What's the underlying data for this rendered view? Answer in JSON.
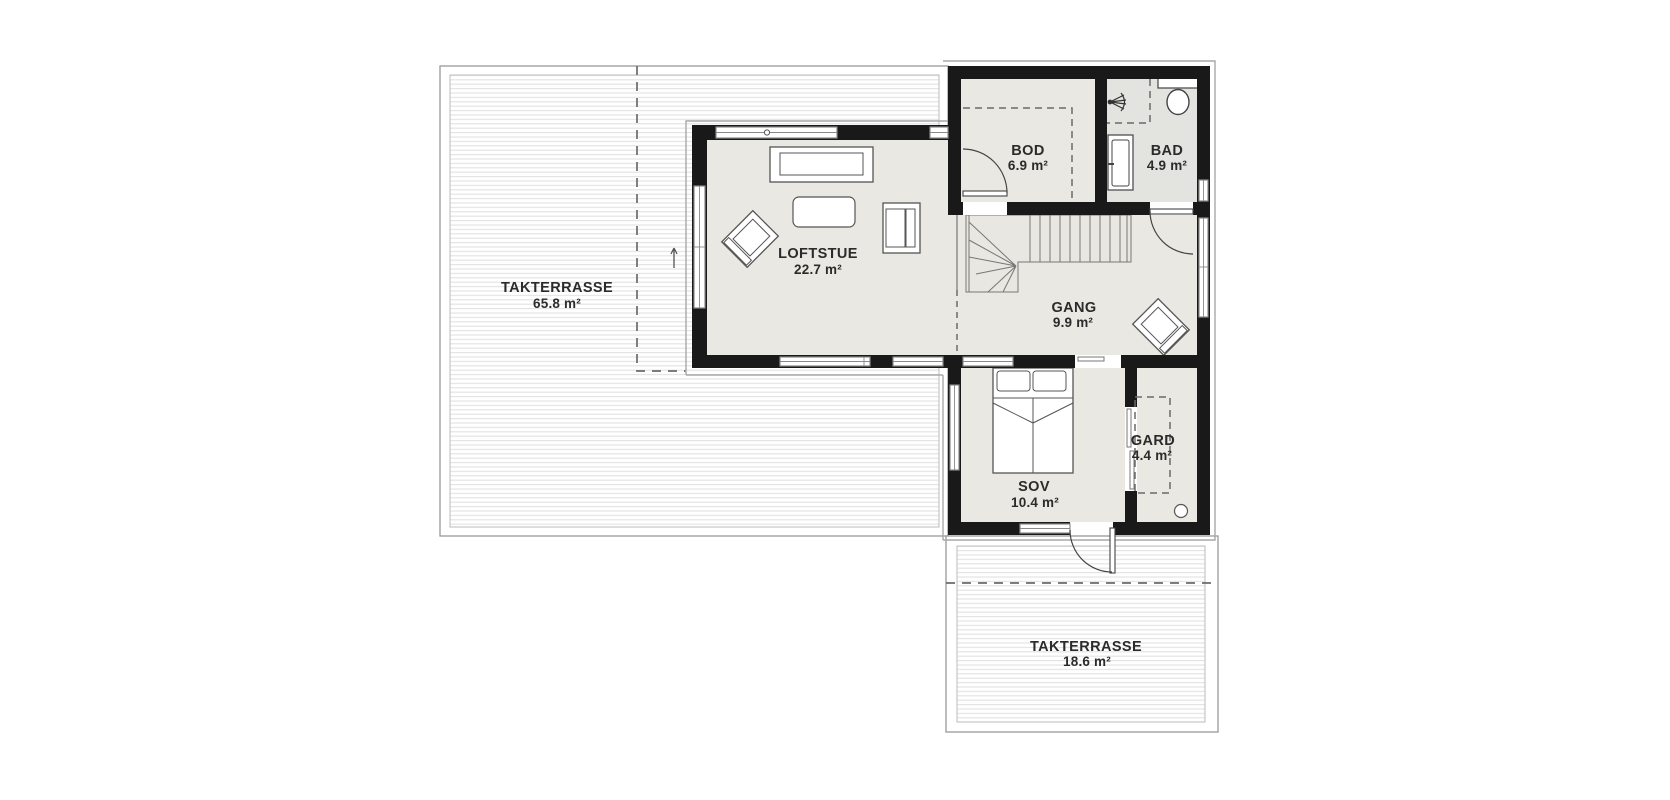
{
  "floorplan": {
    "rooms": [
      {
        "id": "takterrasse-large",
        "name": "TAKTERRASSE",
        "area": "65.8 m²"
      },
      {
        "id": "loftstue",
        "name": "LOFTSTUE",
        "area": "22.7 m²"
      },
      {
        "id": "bod",
        "name": "BOD",
        "area": "6.9 m²"
      },
      {
        "id": "bad",
        "name": "BAD",
        "area": "4.9 m²"
      },
      {
        "id": "gang",
        "name": "GANG",
        "area": "9.9 m²"
      },
      {
        "id": "sov",
        "name": "SOV",
        "area": "10.4 m²"
      },
      {
        "id": "gard",
        "name": "GARD",
        "area": "4.4 m²"
      },
      {
        "id": "takterrasse-small",
        "name": "TAKTERRASSE",
        "area": "18.6 m²"
      }
    ],
    "icons": [
      "staircase",
      "double-bed",
      "sofa",
      "coffee-table",
      "armchair",
      "toilet",
      "washbasin",
      "shower-head",
      "door-swing",
      "sliding-door"
    ],
    "colors": {
      "wall": "#191919",
      "room_floor": "#eae8e2",
      "bath_floor": "#e3e3df",
      "deck_stripe": "#e2e2e2",
      "outline": "#999999",
      "dashed": "#6b6b6b",
      "text": "#2b2b2b"
    }
  }
}
